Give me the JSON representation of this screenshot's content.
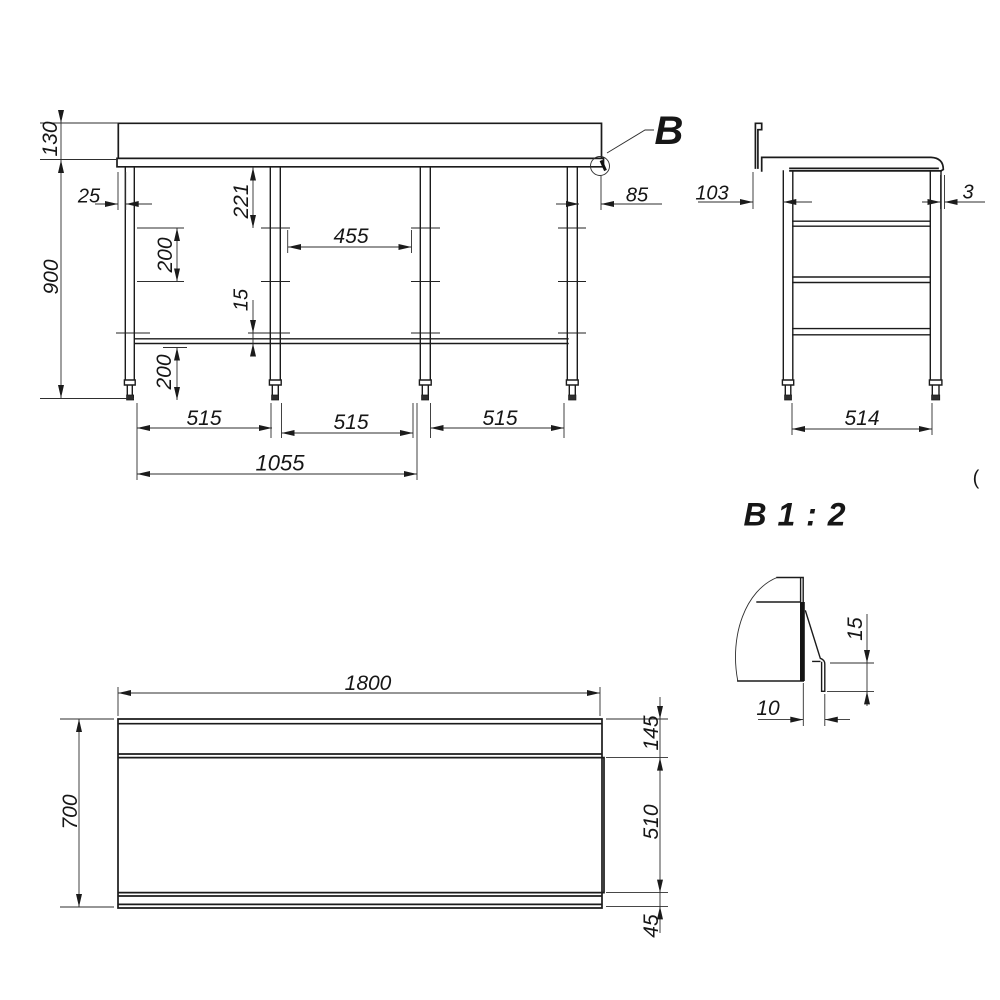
{
  "detail_callout": {
    "label": "B"
  },
  "detail_view": {
    "title": "B 1 : 2",
    "lip_height": "15",
    "lip_offset": "10"
  },
  "front_view": {
    "backsplash_height": "130",
    "overall_height": "900",
    "left_leg_inset": "25",
    "rail_top_offset": "221",
    "upper_rail_spacing": "200",
    "rail_to_shelf_gap": "15",
    "shelf_to_floor": "200",
    "inner_clear_width": "455",
    "right_overhang": "85",
    "bay_width_1": "515",
    "bay_width_2": "515",
    "bay_width_3": "515",
    "double_bay_span": "1055"
  },
  "side_view": {
    "backsplash_to_leg": "103",
    "front_overhang": "3",
    "leg_span": "514"
  },
  "plan_view": {
    "length": "1800",
    "back_band_depth": "145",
    "work_surface_depth": "510",
    "overall_depth": "700",
    "front_edge_band": "45"
  },
  "stray_mark": "("
}
